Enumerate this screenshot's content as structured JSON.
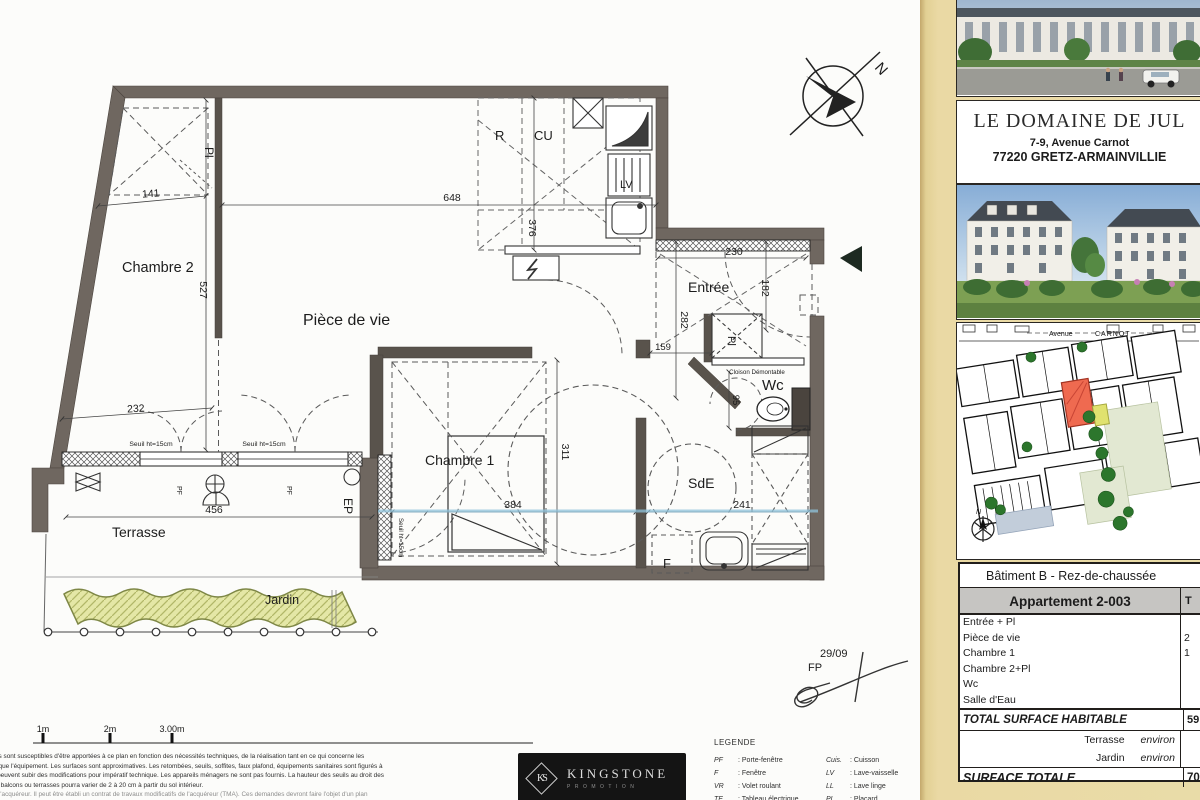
{
  "plan": {
    "rooms": {
      "chambre2": "Chambre 2",
      "piece_de_vie": "Pièce de vie",
      "chambre1": "Chambre 1",
      "entree": "Entrée",
      "wc": "Wc",
      "sde": "SdE",
      "terrasse": "Terrasse",
      "jardin": "Jardin"
    },
    "annotations": {
      "pl_top": "Pl",
      "pl_entree": "Pl",
      "r": "R",
      "cu": "CU",
      "lv": "LV",
      "f": "F",
      "ep": "EP",
      "pf1": "PF",
      "pf2": "PF",
      "cloison": "Cloison Démontable",
      "seuil1": "Seuil ht=15cm",
      "seuil2": "Seuil ht=15cm",
      "seuil3": "Seuil ht=15cm",
      "north": "N",
      "date": "29/09",
      "initials": "FP"
    },
    "dimensions": {
      "d141": "141",
      "d648": "648",
      "d376": "376",
      "d527": "527",
      "d232": "232",
      "d456": "456",
      "d384": "384",
      "d311": "311",
      "d241": "241",
      "d230": "230",
      "d182": "182",
      "d282": "282",
      "d159": "159",
      "d95": "95"
    }
  },
  "sidebar": {
    "title": "LE DOMAINE DE JUL",
    "address1": "7-9, Avenue Carnot",
    "address2": "77220 GRETZ-ARMAINVILLIE",
    "siteplan": {
      "street1": "Avenue",
      "street2": "CARNOT",
      "north": "N"
    },
    "table": {
      "building": "Bâtiment B  -  Rez-de-chaussée",
      "apartment": "Appartement 2-003",
      "col_partial": "T",
      "rows": [
        {
          "label": "Entrée + Pl",
          "value": ""
        },
        {
          "label": "Pièce de vie",
          "value": "2"
        },
        {
          "label": "Chambre 1",
          "value": "1"
        },
        {
          "label": "Chambre 2+Pl",
          "value": ""
        },
        {
          "label": "Wc",
          "value": ""
        },
        {
          "label": "Salle d'Eau",
          "value": ""
        }
      ],
      "total_label": "TOTAL SURFACE HABITABLE",
      "total_value": "59",
      "annex": [
        {
          "label": "Terrasse",
          "qualifier": "environ"
        },
        {
          "label": "Jardin",
          "qualifier": "environ"
        }
      ],
      "grand_label": "SURFACE TOTALE",
      "grand_value": "70"
    }
  },
  "footer": {
    "scale_labels": [
      "1m",
      "2m",
      "3.00m"
    ],
    "disclaimer": [
      "ions sont susceptibles d'être apportées à ce plan en fonction des nécessités techniques, de la réalisation tant en ce qui concerne les",
      "es que l'équipement. Les surfaces sont approximatives. Les retombées, seuils, soffites, faux plafond, équipements sanitaires sont figurés à",
      "et peuvent subir des modifications pour impératif technique. Les appareils ménagers ne sont pas fournis. La hauteur des seuils au droit des",
      "sur balcons ou terrasses pourra varier de 2 à 20 cm à partir du sol intérieur.",
      "de l'acquéreur. Il peut être établi un contrat de travaux modificatifs de l'acquéreur (TMA). Ces demandes devront faire l'objet d'un plan"
    ],
    "logo": {
      "monogram": "KS",
      "name": "KINGSTONE",
      "subtitle": "PROMOTION"
    },
    "legend": {
      "title": "LEGENDE",
      "left": [
        {
          "abbr": "PF",
          "label": ": Porte-fenêtre"
        },
        {
          "abbr": "F",
          "label": ": Fenêtre"
        },
        {
          "abbr": "VR",
          "label": ": Volet roulant"
        },
        {
          "abbr": "TE",
          "label": ": Tableau électrique"
        },
        {
          "abbr": "Ch",
          "label": ": Chaudière"
        }
      ],
      "right": [
        {
          "abbr": "Cuis.",
          "label": ": Cuisson"
        },
        {
          "abbr": "LV",
          "label": ": Lave-vaisselle"
        },
        {
          "abbr": "LL",
          "label": ": Lave linge"
        },
        {
          "abbr": "PL",
          "label": ": Placard"
        },
        {
          "abbr": "▱",
          "label": ": Soffite"
        }
      ]
    }
  }
}
